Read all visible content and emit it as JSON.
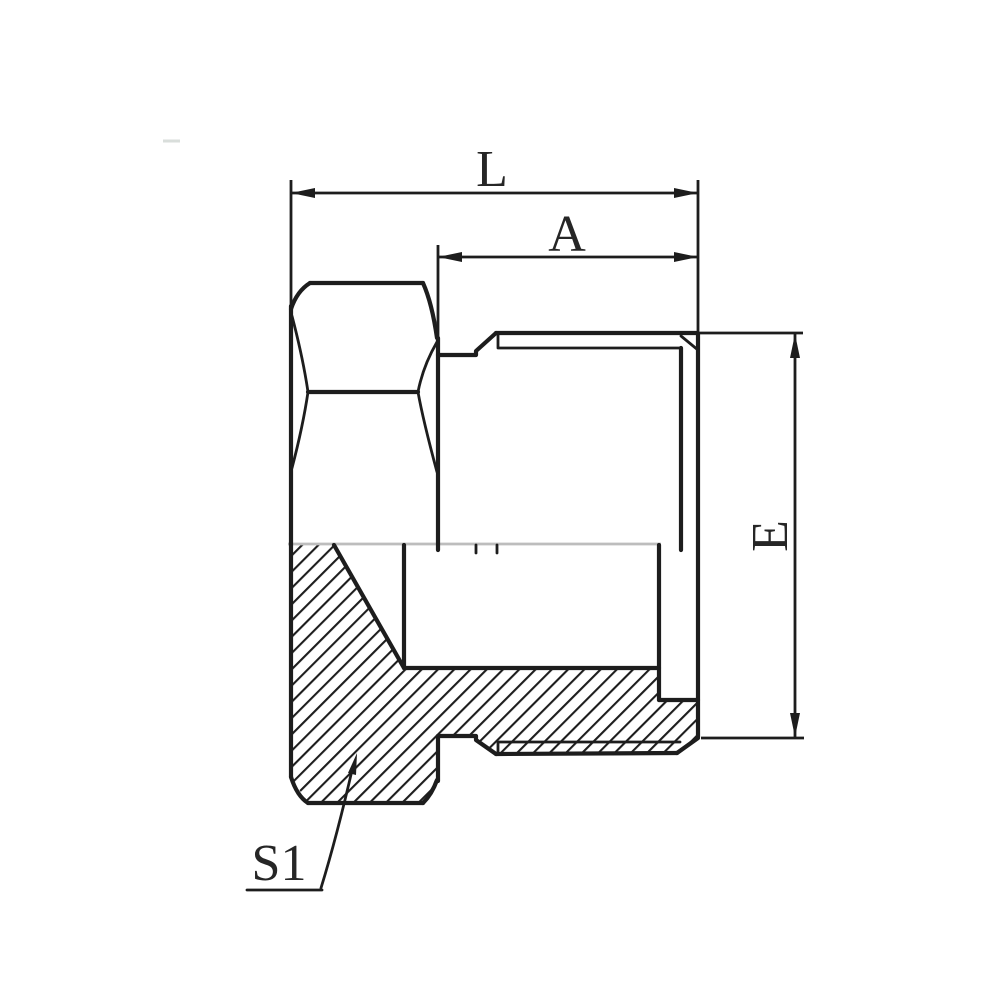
{
  "drawing": {
    "kind": "technical-section-drawing",
    "part": "hex-hollow-plug-fitting",
    "labels": {
      "overall_length": "L",
      "thread_length": "A",
      "end_diameter": "E",
      "hex_size": "S1"
    },
    "colors": {
      "line": "#1d1d1d",
      "text": "#262626",
      "centerline": "#bdbdbd",
      "background": "#ffffff",
      "artifact": "#d9dedb"
    }
  }
}
